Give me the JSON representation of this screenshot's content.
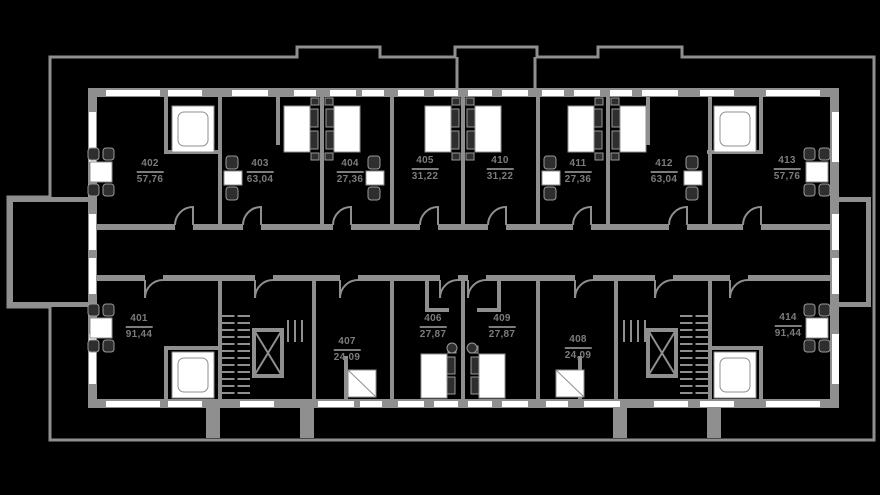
{
  "title": "Residential floor plan, level 4",
  "colors": {
    "bg": "#000000",
    "wall": "#8f8f8f",
    "win": "#ffffff",
    "dark": "#2e2e2e",
    "text": "#7c7c7c"
  },
  "apartments": [
    {
      "number": "401",
      "area": "91,44"
    },
    {
      "number": "402",
      "area": "57,76"
    },
    {
      "number": "403",
      "area": "63,04"
    },
    {
      "number": "404",
      "area": "27,36"
    },
    {
      "number": "405",
      "area": "31,22"
    },
    {
      "number": "406",
      "area": "27,87"
    },
    {
      "number": "407",
      "area": "24,09"
    },
    {
      "number": "408",
      "area": "24,09"
    },
    {
      "number": "409",
      "area": "27,87"
    },
    {
      "number": "410",
      "area": "31,22"
    },
    {
      "number": "411",
      "area": "27,36"
    },
    {
      "number": "412",
      "area": "63,04"
    },
    {
      "number": "413",
      "area": "57,76"
    },
    {
      "number": "414",
      "area": "91,44"
    }
  ],
  "legend_symbols": [
    "elevator-icon",
    "staircase-icon",
    "double-bed-icon",
    "bathtub-icon",
    "shower-icon",
    "washer-icon",
    "dining-table-icon",
    "window",
    "door-arc",
    "balcony"
  ]
}
